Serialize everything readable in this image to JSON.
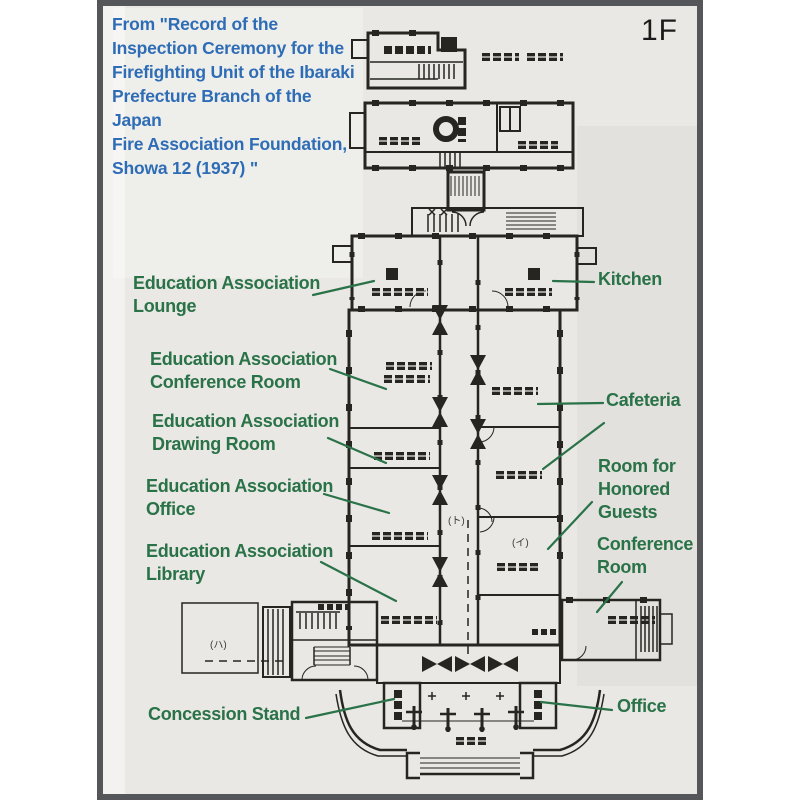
{
  "caption": {
    "lines": [
      "From \"Record of the",
      "Inspection Ceremony for the",
      "Firefighting Unit of the Ibaraki",
      "Prefecture Branch of the Japan",
      "Fire Association Foundation,",
      "Showa 12 (1937) \""
    ]
  },
  "floor_indicator": "1F",
  "annotations": {
    "education_lounge": {
      "lines": [
        "Education Association",
        "Lounge"
      ]
    },
    "kitchen": {
      "lines": [
        "Kitchen"
      ]
    },
    "education_conference_room": {
      "lines": [
        "Education Association",
        "Conference Room"
      ]
    },
    "cafeteria": {
      "lines": [
        "Cafeteria"
      ]
    },
    "education_drawing_room": {
      "lines": [
        "Education Association",
        "Drawing Room"
      ]
    },
    "room_for_honored_guests": {
      "lines": [
        "Room for",
        "Honored",
        "Guests"
      ]
    },
    "education_office": {
      "lines": [
        "Education Association",
        "Office"
      ]
    },
    "conference_room": {
      "lines": [
        "Conference",
        "Room"
      ]
    },
    "education_library": {
      "lines": [
        "Education Association",
        "Library"
      ]
    },
    "concession_stand": {
      "lines": [
        "Concession Stand"
      ]
    },
    "office": {
      "lines": [
        "Office"
      ]
    }
  },
  "plan_marks": {
    "ha": "(ハ)",
    "to": "(ト)",
    "i": "(イ)"
  },
  "colors": {
    "caption-blue": "#2e6db6",
    "annotation-green": "#2a7248",
    "frame-gray": "#55565a",
    "paper": "#e9e8e4",
    "ink": "#26251f"
  }
}
